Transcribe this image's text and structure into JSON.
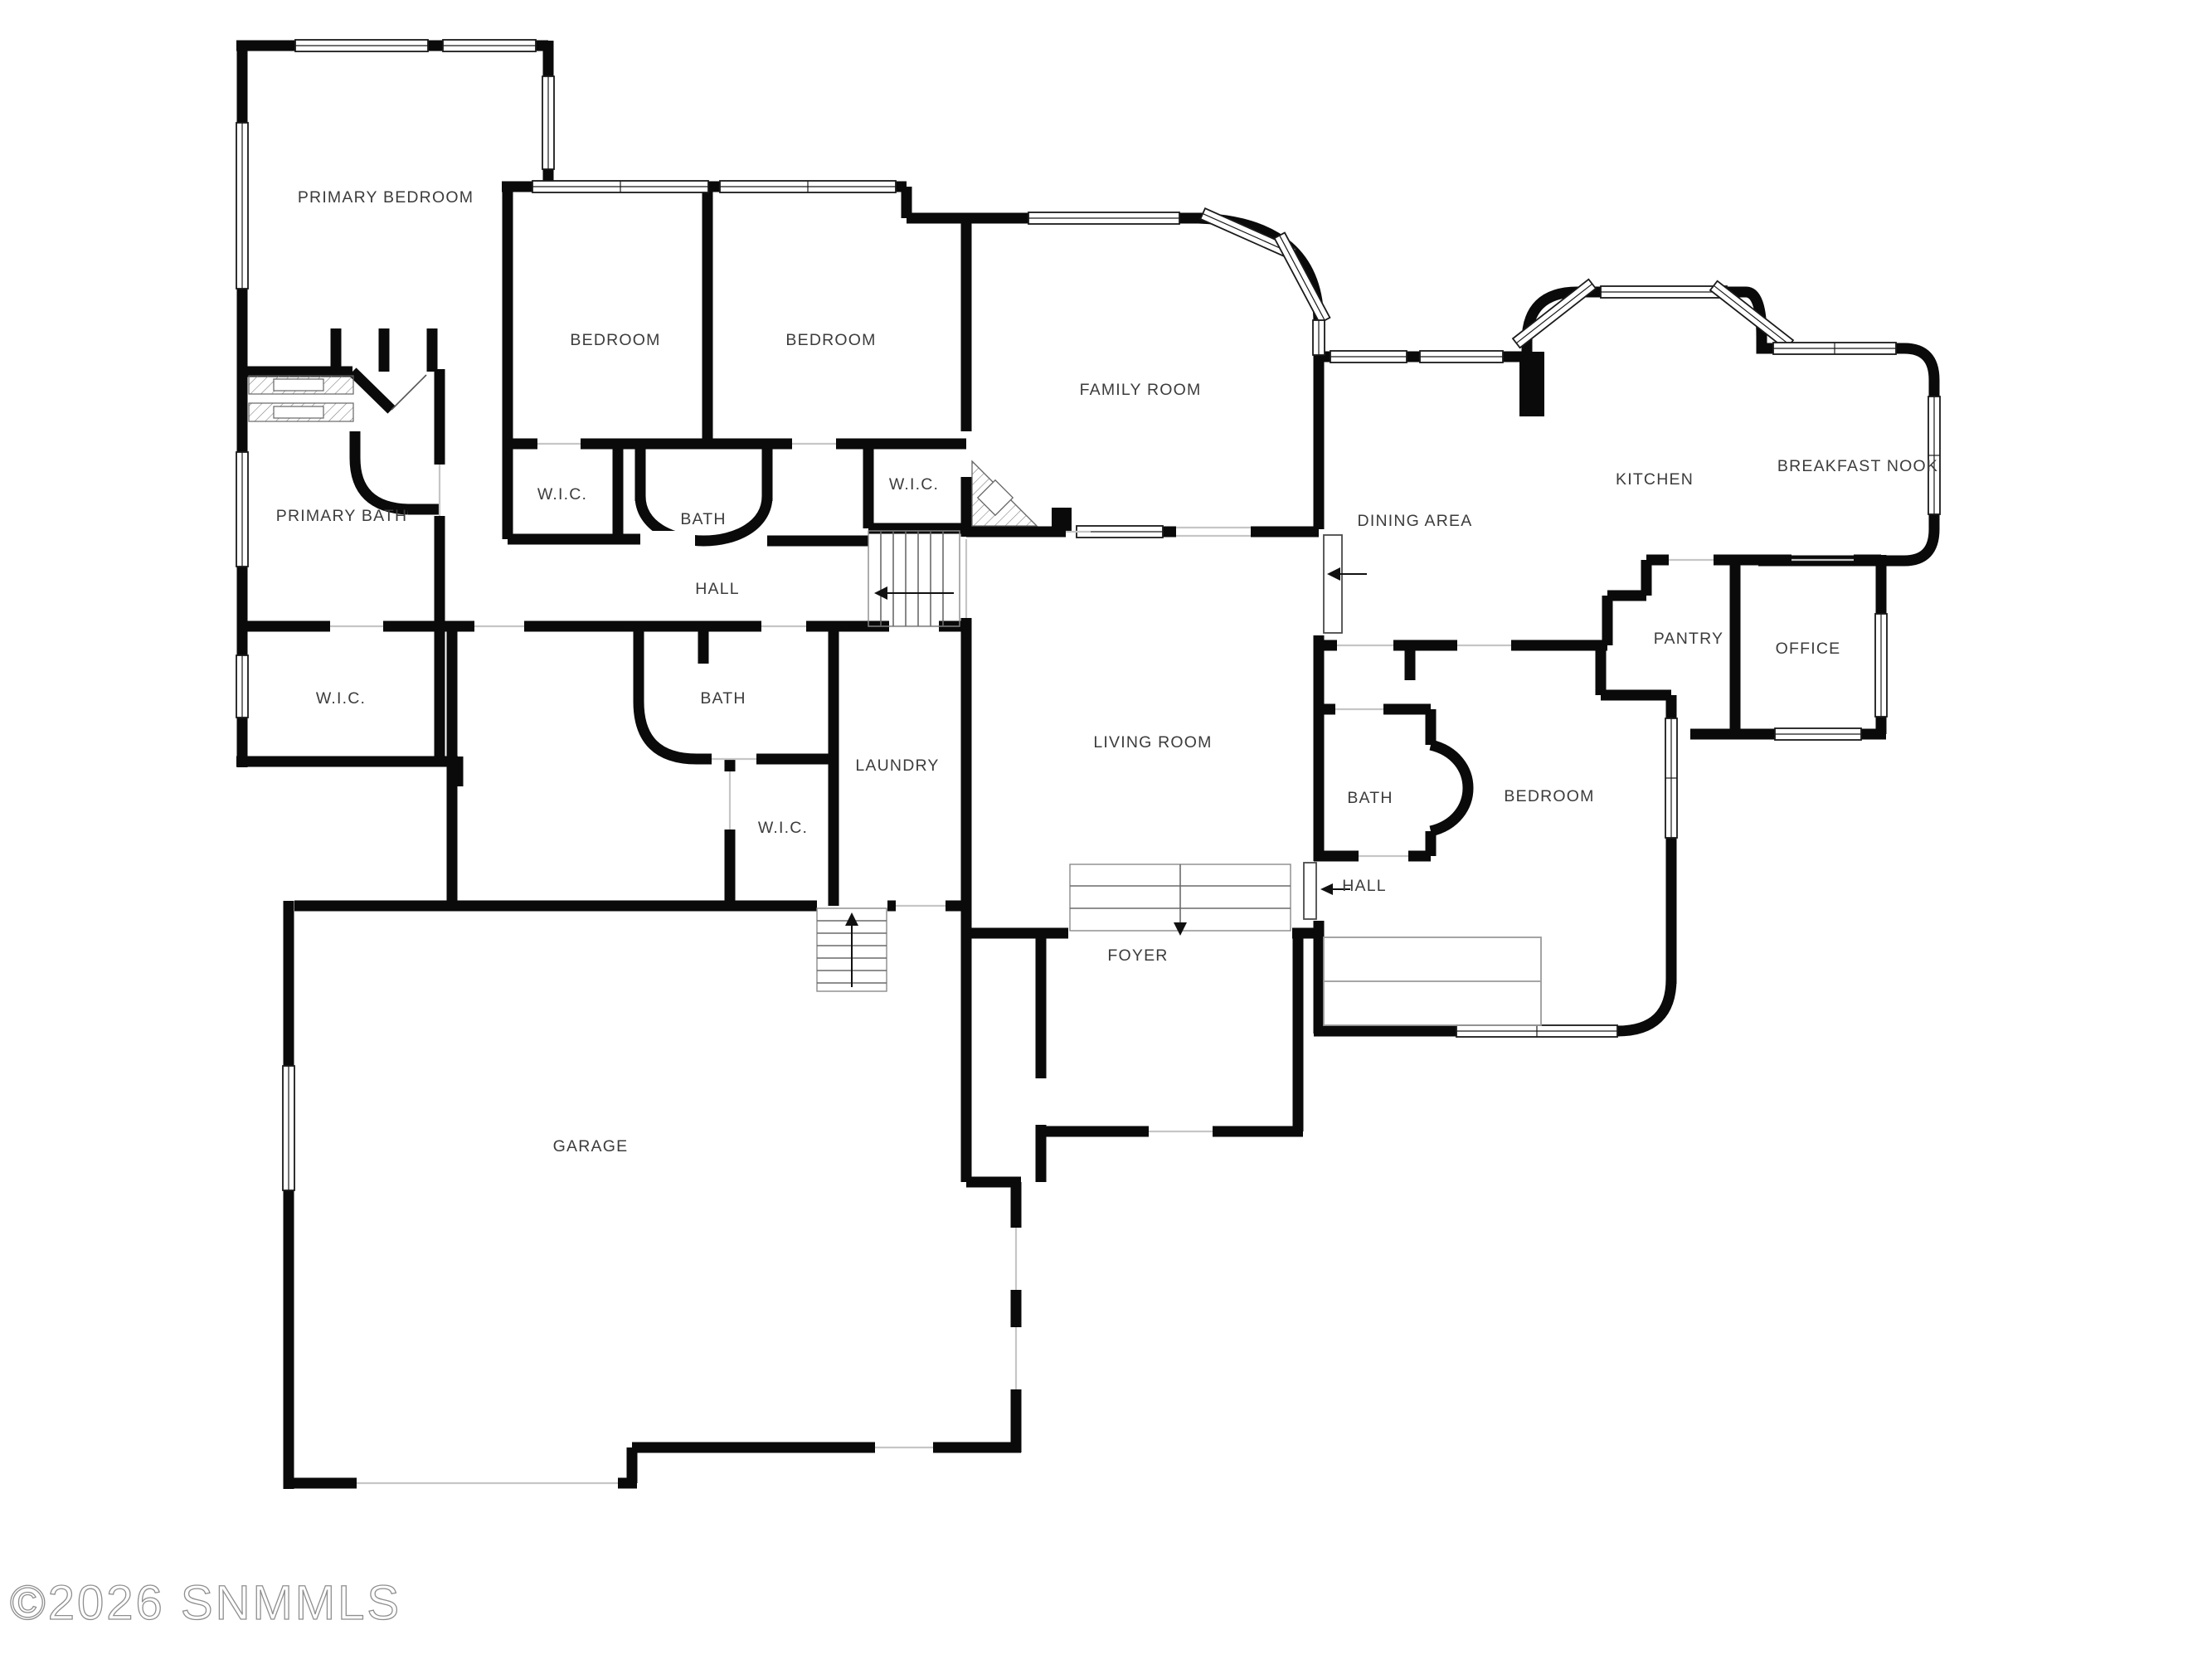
{
  "floor_plan": {
    "watermark": "©2026 SNMMLS",
    "wall_color": "#0a0a0a",
    "label_color": "#3c3c3c",
    "rooms": [
      {
        "id": "primary-bedroom",
        "label": "PRIMARY BEDROOM"
      },
      {
        "id": "bedroom-west-1",
        "label": "BEDROOM"
      },
      {
        "id": "bedroom-west-2",
        "label": "BEDROOM"
      },
      {
        "id": "family-room",
        "label": "FAMILY ROOM"
      },
      {
        "id": "kitchen",
        "label": "KITCHEN"
      },
      {
        "id": "breakfast-nook",
        "label": "BREAKFAST NOOK"
      },
      {
        "id": "dining-area",
        "label": "DINING AREA"
      },
      {
        "id": "wic-bedroom-1",
        "label": "W.I.C."
      },
      {
        "id": "bath-bedroom-wing",
        "label": "BATH"
      },
      {
        "id": "wic-bedroom-2",
        "label": "W.I.C."
      },
      {
        "id": "primary-bath",
        "label": "PRIMARY BATH"
      },
      {
        "id": "hall-west",
        "label": "HALL"
      },
      {
        "id": "pantry",
        "label": "PANTRY"
      },
      {
        "id": "office",
        "label": "OFFICE"
      },
      {
        "id": "wic-primary",
        "label": "W.I.C."
      },
      {
        "id": "bath-west",
        "label": "BATH"
      },
      {
        "id": "living-room",
        "label": "LIVING ROOM"
      },
      {
        "id": "bath-east",
        "label": "BATH"
      },
      {
        "id": "bedroom-east",
        "label": "BEDROOM"
      },
      {
        "id": "wic-bedroom-3",
        "label": "W.I.C."
      },
      {
        "id": "laundry",
        "label": "LAUNDRY"
      },
      {
        "id": "hall-east",
        "label": "HALL"
      },
      {
        "id": "foyer",
        "label": "FOYER"
      },
      {
        "id": "garage",
        "label": "GARAGE"
      }
    ]
  }
}
